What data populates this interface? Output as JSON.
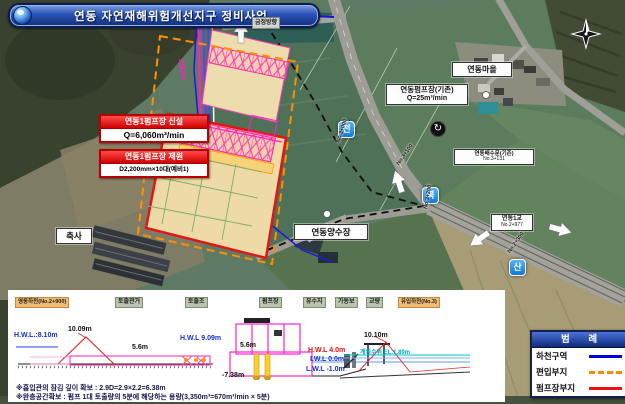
{
  "banner": {
    "title": "연동 자연재해위험개선지구 정비사업"
  },
  "map": {
    "direction_top": "금정방향",
    "village": "연동마을",
    "pump_existing": {
      "line1": "연동펌프장(기존)",
      "line2": "Q=25m³/min"
    },
    "pump_new": {
      "header": "연동1펌프장 신설",
      "value": "Q=6,060m³/min"
    },
    "pump_spec": {
      "header": "연동1펌프장 제원",
      "value": "D2,200mm×10대(예비1)"
    },
    "yangsu": "연동양수장",
    "chuksa": "축사",
    "sluice": {
      "name": "연동배수문(기존)",
      "station": "No.3+131"
    },
    "bridge": {
      "name": "연동1교",
      "station": "No.2+977"
    },
    "badge_jeon": "전",
    "badge_buk": "북",
    "badge_san": "산",
    "stations": [
      "No.3+000",
      "No.3+100",
      "No.3+200",
      "No.2+300"
    ],
    "conduit": "토출관거",
    "icons": {
      "rotate": "↻"
    }
  },
  "legend": {
    "title": "범  례",
    "items": [
      {
        "label": "하천구역",
        "style": "solid",
        "color": "#0000dd"
      },
      {
        "label": "편입부지",
        "style": "dashed",
        "color": "#ff8800"
      },
      {
        "label": "펌프장부지",
        "style": "solid",
        "color": "#ee1111"
      }
    ]
  },
  "section": {
    "labels": {
      "river_left": "영동하천(No.2+900)",
      "discharge_conduit": "토출관거",
      "discharge_tank": "토출조",
      "pump_station": "펌프장",
      "retention": "유수지",
      "weir": "가동보",
      "bridge": "교량",
      "river_right": "유입하천(No.3)"
    },
    "measures": {
      "hwl_left": "H.W.L.:8.10m",
      "levee_left": "10.09m",
      "len_a": "5.6m",
      "hwl_mid": "H.W.L 9.09m",
      "len_b": "5.6m",
      "depth": "-7.38m",
      "hwl_right": "H.W.L 4.0m",
      "iwl_right": "I.W.L 0.0m",
      "lwl_right": "L.W.L -1.0m",
      "levee_right": "10.10m",
      "plan_wl": "계획수위 EL.1.89m"
    },
    "notes": [
      "※흡입관의 잠김 깊이 확보 : 2.9D=2.9×2.2=6.38m",
      "※완충공간확보 : 펌프 1대 토출량의 5분에 해당하는 용량(3,350m³=670m³/min × 5분)"
    ]
  }
}
